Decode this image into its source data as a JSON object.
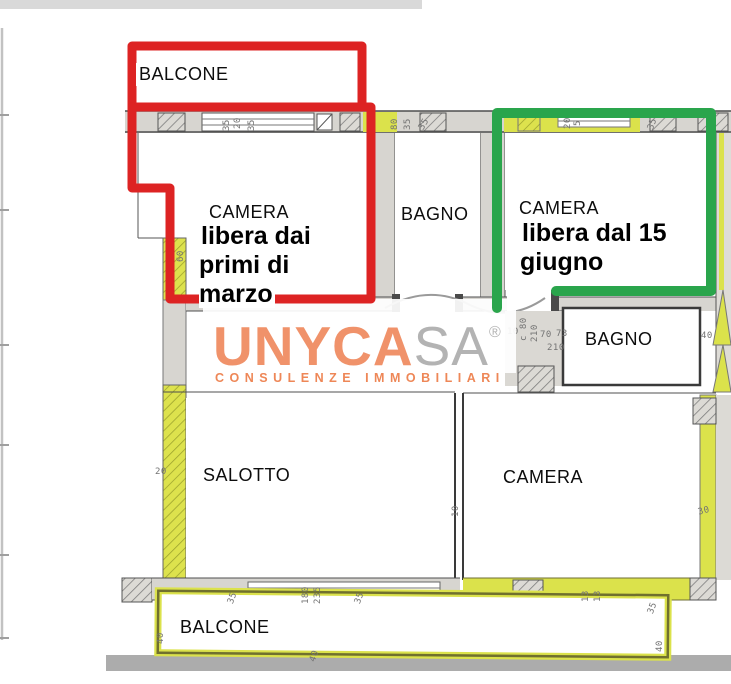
{
  "colors": {
    "annotation_red": "#dd2323",
    "annotation_green": "#2aa54c",
    "highlight_yellow": "#dbe24b",
    "logo_orange": "#f0926a",
    "logo_gray": "#b3b3b3",
    "tagline_orange": "#ee8757"
  },
  "rooms": {
    "balcone_top": {
      "label": "BALCONE"
    },
    "camera_left": {
      "label": "CAMERA",
      "note": "libera dai\nprimi di\nmarzo"
    },
    "bagno_top": {
      "label": "BAGNO"
    },
    "camera_right": {
      "label": "CAMERA",
      "note": "libera dal 15\ngiugno"
    },
    "bagno_right": {
      "label": "BAGNO"
    },
    "salotto": {
      "label": "SALOTTO"
    },
    "camera_bottom": {
      "label": "CAMERA"
    },
    "balcone_bottom": {
      "label": "BALCONE"
    }
  },
  "logo": {
    "brand_primary": "UNYCA",
    "brand_secondary": "SA",
    "registered": "®",
    "tagline": "CONSULENZE IMMOBILIARI"
  },
  "dimensions": [
    {
      "t": "180",
      "x": 500,
      "y": -7,
      "r": 0
    },
    {
      "t": "400",
      "x": 552,
      "y": -7,
      "r": 0
    },
    {
      "t": "40",
      "x": 612,
      "y": -7,
      "r": 0
    },
    {
      "t": "4",
      "x": 660,
      "y": -7,
      "r": 0
    },
    {
      "t": "200",
      "x": 714,
      "y": -7,
      "r": 0
    },
    {
      "t": "35",
      "x": 222,
      "y": 131,
      "r": -90
    },
    {
      "t": "20",
      "x": 233,
      "y": 129,
      "r": -90
    },
    {
      "t": "35",
      "x": 247,
      "y": 131,
      "r": -90
    },
    {
      "t": "80",
      "x": 390,
      "y": 130,
      "r": -90
    },
    {
      "t": "35",
      "x": 403,
      "y": 130,
      "r": -90
    },
    {
      "t": "35",
      "x": 417,
      "y": 127,
      "r": -60
    },
    {
      "t": "20",
      "x": 563,
      "y": 129,
      "r": -90
    },
    {
      "t": "5",
      "x": 573,
      "y": 126,
      "r": -90
    },
    {
      "t": "35",
      "x": 646,
      "y": 128,
      "r": -70
    },
    {
      "t": "60",
      "x": 176,
      "y": 262,
      "r": -90
    },
    {
      "t": "c 80",
      "x": 519,
      "y": 341,
      "r": -90
    },
    {
      "t": "210",
      "x": 530,
      "y": 342,
      "r": -90
    },
    {
      "t": "10",
      "x": 507,
      "y": 327,
      "r": 0
    },
    {
      "t": "70",
      "x": 540,
      "y": 330,
      "r": 0
    },
    {
      "t": "73",
      "x": 556,
      "y": 329,
      "r": 0
    },
    {
      "t": "210",
      "x": 547,
      "y": 343,
      "r": 0
    },
    {
      "t": "40",
      "x": 701,
      "y": 331,
      "r": 0
    },
    {
      "t": "20",
      "x": 155,
      "y": 467,
      "r": 0
    },
    {
      "t": "10",
      "x": 451,
      "y": 517,
      "r": -90
    },
    {
      "t": "30",
      "x": 697,
      "y": 508,
      "r": -15
    },
    {
      "t": "35",
      "x": 226,
      "y": 602,
      "r": -70
    },
    {
      "t": "180",
      "x": 301,
      "y": 604,
      "r": -90
    },
    {
      "t": "235",
      "x": 313,
      "y": 604,
      "r": -90
    },
    {
      "t": "35",
      "x": 353,
      "y": 602,
      "r": -70
    },
    {
      "t": "13",
      "x": 581,
      "y": 602,
      "r": -90
    },
    {
      "t": "13",
      "x": 593,
      "y": 602,
      "r": -90
    },
    {
      "t": "35",
      "x": 646,
      "y": 612,
      "r": -70
    },
    {
      "t": "40",
      "x": 156,
      "y": 644,
      "r": -90
    },
    {
      "t": "40",
      "x": 308,
      "y": 660,
      "r": -70
    },
    {
      "t": "40",
      "x": 655,
      "y": 652,
      "r": -90
    }
  ]
}
